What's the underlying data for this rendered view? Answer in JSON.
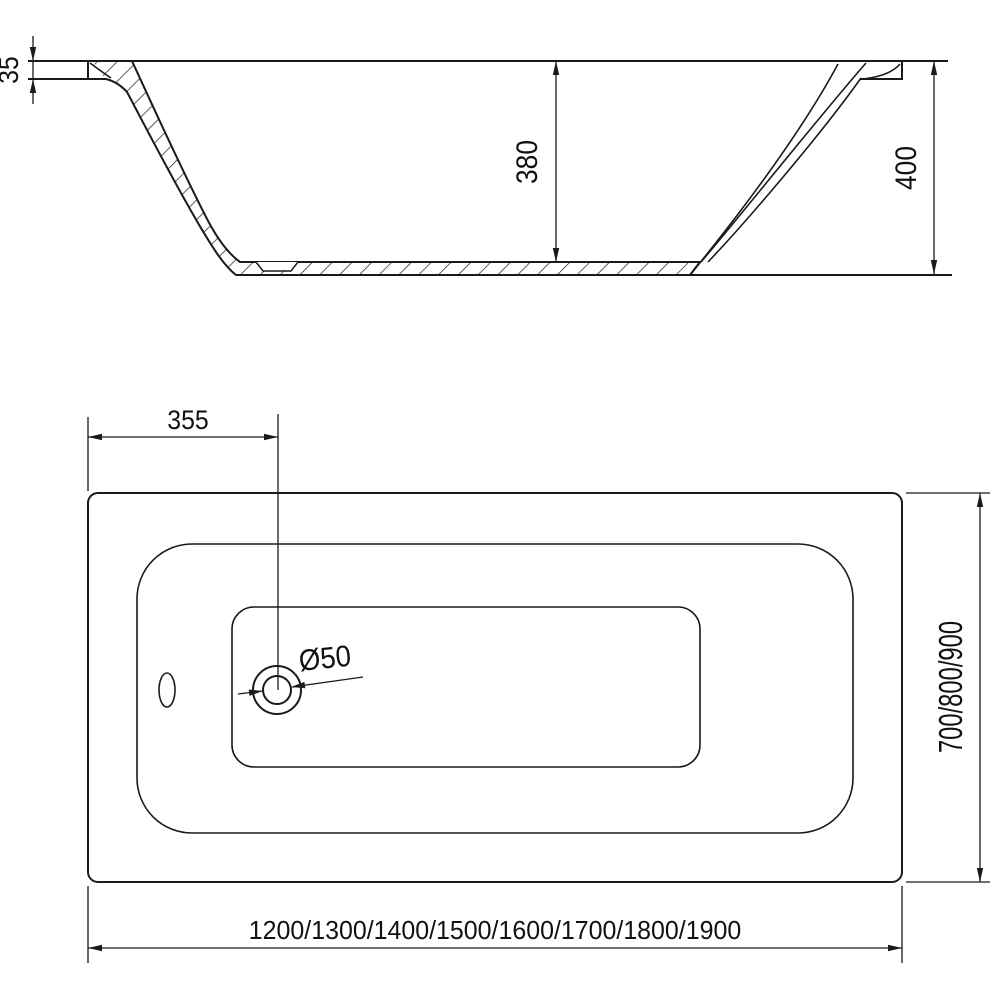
{
  "drawing": {
    "type": "bathtub technical drawing, two orthographic views",
    "colors": {
      "line": "#1a1a1a",
      "background": "#ffffff",
      "text": "#111111"
    },
    "side_view": {
      "rim_thickness": "35",
      "inner_depth": "380",
      "overall_height": "400"
    },
    "plan_view": {
      "drain_offset": "355",
      "drain_diameter": "Ø50",
      "length_options": "1200/1300/1400/1500/1600/1700/1800/1900",
      "width_options": "700/800/900"
    }
  }
}
